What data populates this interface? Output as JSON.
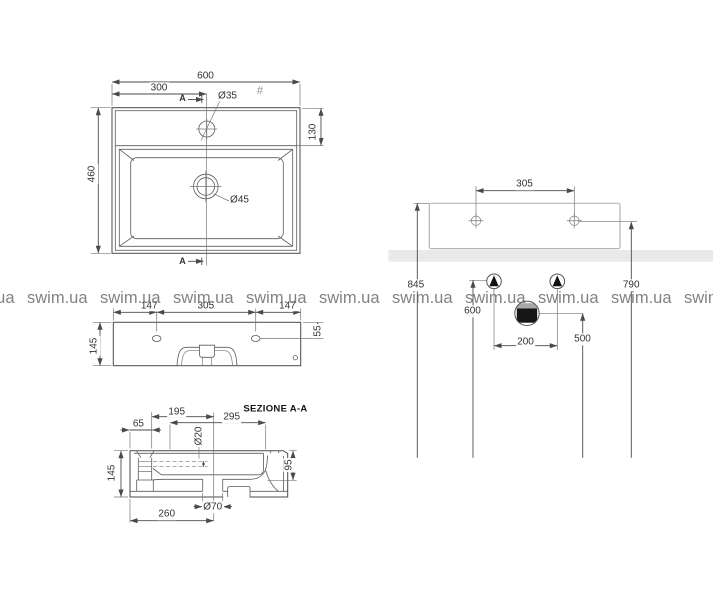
{
  "watermark": {
    "text": "swim.ua"
  },
  "views": {
    "top": {
      "width_600": "600",
      "faucet_offset_300": "300",
      "section_marker": "A",
      "faucet_hole_d35": "Ø35",
      "hash_mark": "#",
      "shelf_depth_130": "130",
      "depth_460": "460",
      "drain_hole_d45": "Ø45"
    },
    "front": {
      "side_147_left": "147",
      "holes_span_305": "305",
      "side_147_right": "147",
      "height_145": "145",
      "hole_offset_55": "55"
    },
    "section": {
      "title": "SEZIONE A-A",
      "drain_offset_195": "195",
      "back_span_295": "295",
      "overflow_65": "65",
      "overflow_hole_d20": "Ø20",
      "basin_depth_95": "95",
      "height_145": "145",
      "drain_d70": "Ø70",
      "drain_from_side_260": "260"
    },
    "installation": {
      "holes_span_305": "305",
      "rim_height_845": "845",
      "holes_height_790": "790",
      "supply_height_600": "600",
      "drain_height_500": "500",
      "supply_spacing_200": "200"
    }
  },
  "colors": {
    "drawing_line": "#4a4a4a",
    "light_outline": "#b5b5b5",
    "shelf_band": "#e9e9e9",
    "dimension_text": "#333333",
    "watermark_text": "#5f5f5f",
    "symbol_fill": "#111111"
  }
}
